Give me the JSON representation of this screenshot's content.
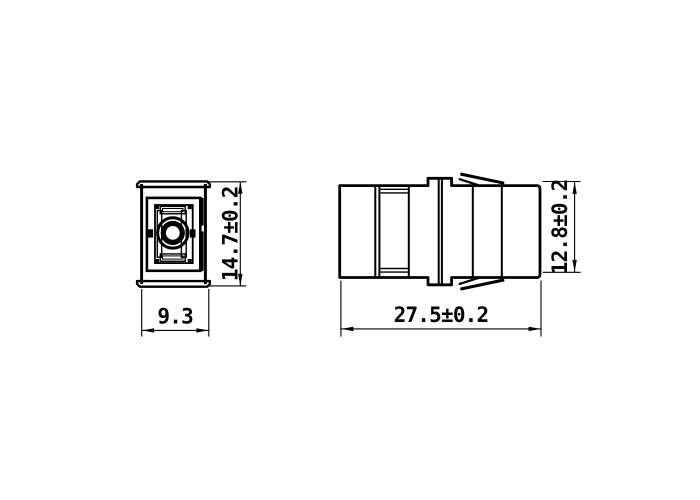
{
  "colors": {
    "line": "#000000",
    "background": "#ffffff"
  },
  "views": {
    "front": {
      "height_dimension": "14.7±0.2",
      "width_dimension": "9.3"
    },
    "side": {
      "length_dimension": "27.5±0.2",
      "height_dimension": "12.8±0.2"
    }
  }
}
